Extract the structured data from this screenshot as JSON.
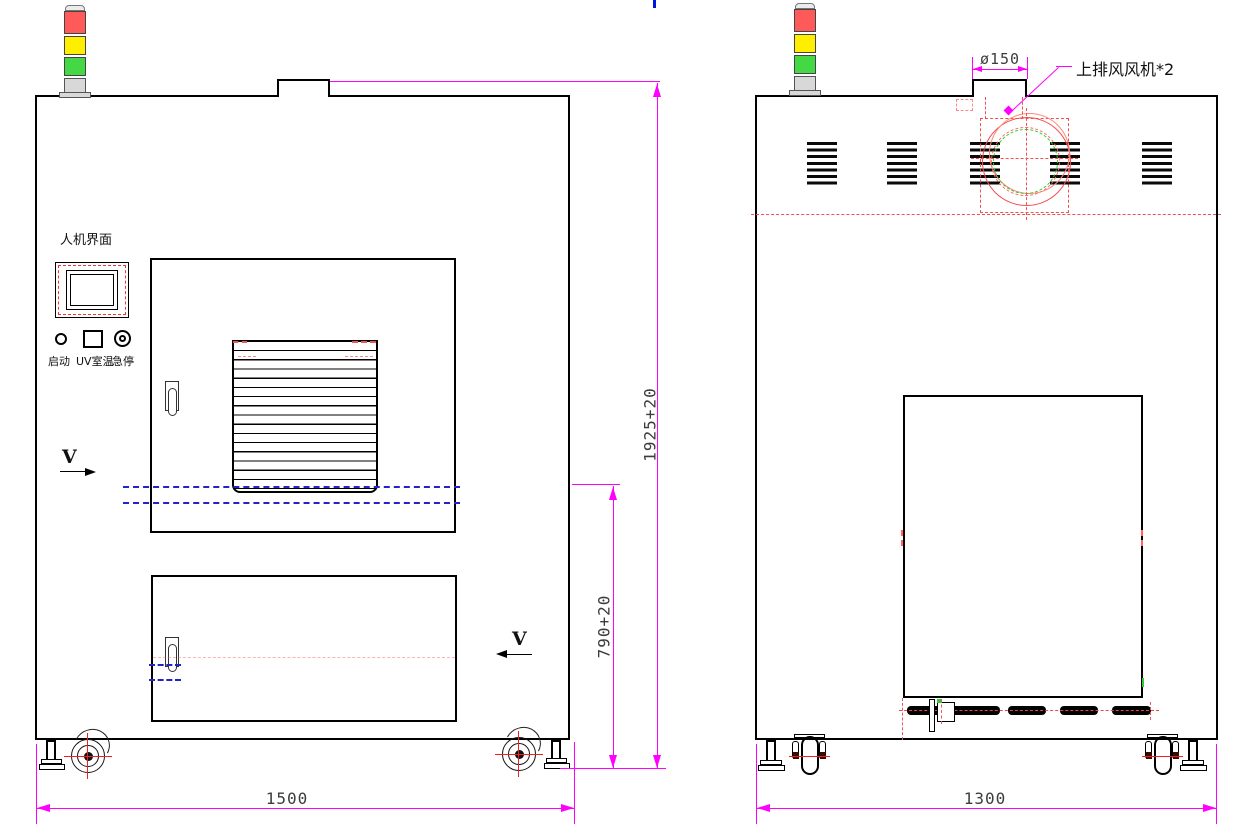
{
  "front_view": {
    "hmi_label": "人机界面",
    "btn_start": "启动",
    "btn_uv_temp": "UV室温",
    "btn_estop": "急停",
    "section_marker": "V",
    "dim_width": "1500",
    "dim_height": "1925+20",
    "dim_lower_section": "790+20"
  },
  "side_view": {
    "dim_width": "1300",
    "dim_fan_diameter": "ø150",
    "fan_label": "上排风风机*2"
  },
  "colors": {
    "dim": "#ff00ff",
    "red": "#f25050",
    "blue": "#2323c8",
    "green": "#2ecc2e",
    "tower-red": "#ff5a5a",
    "tower-yellow": "#ffee00",
    "tower-green": "#44d844",
    "tower-gray": "#d8d8d8"
  }
}
